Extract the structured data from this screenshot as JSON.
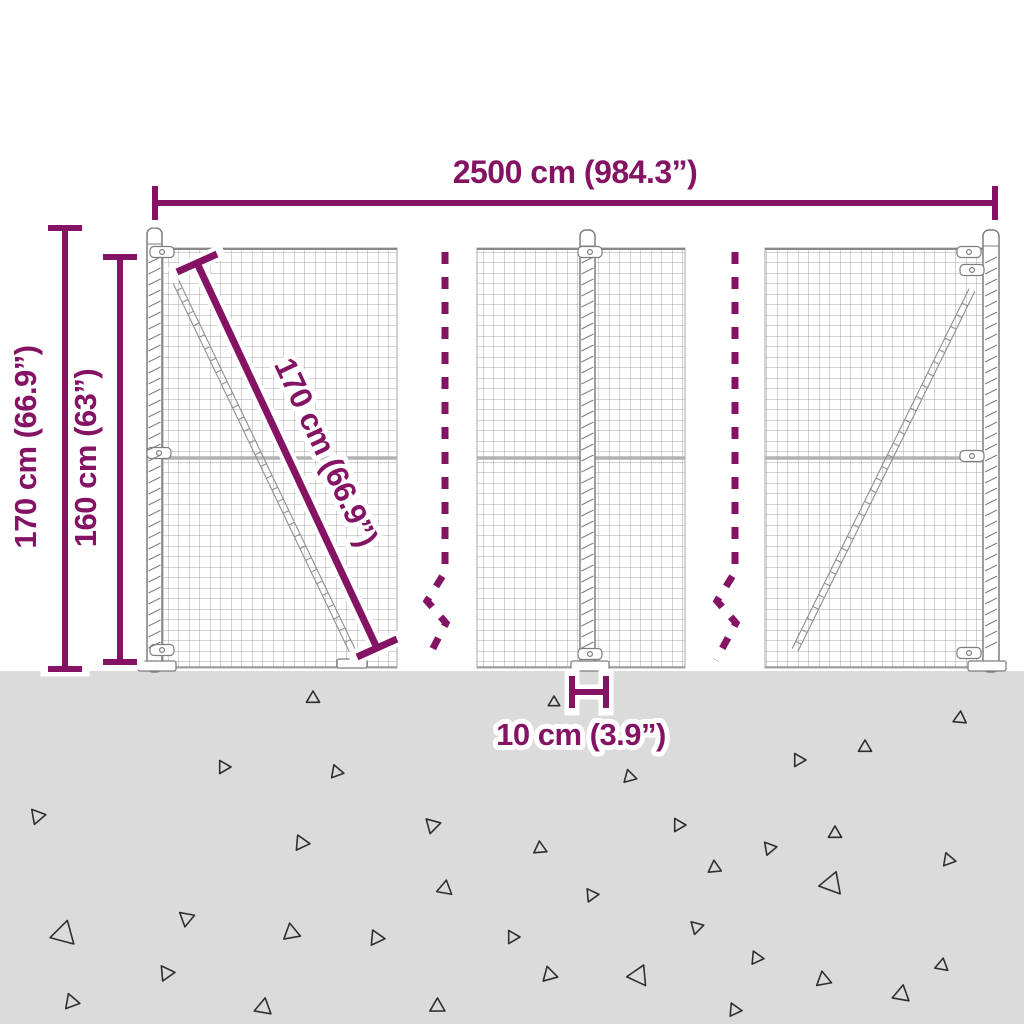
{
  "colors": {
    "accent": "#841363",
    "background": "#ffffff",
    "ground": "#dbdbdb",
    "mesh_line": "#a7a7a7",
    "mesh_wire": "#8a8a8a",
    "rail": "#b3b3b3",
    "post_stroke": "#7e7e7e",
    "hardware": "#8f8f8f",
    "triangle": "#2f2f2f"
  },
  "dimensions": {
    "total_width_label": "2500 cm (984.3”)",
    "post_height_label": "170 cm (66.9”)",
    "mesh_height_label": "160 cm (63”)",
    "panel_diagonal_label": "170 cm (66.9”)",
    "anchor_label": "10 cm (3.9”)"
  },
  "ground": {
    "triangles": [
      [
        313,
        698,
        7,
        0
      ],
      [
        224,
        767,
        7,
        90
      ],
      [
        337,
        772,
        7,
        100
      ],
      [
        38,
        816,
        8,
        80
      ],
      [
        433,
        825,
        8,
        75
      ],
      [
        302,
        843,
        8,
        95
      ],
      [
        445,
        888,
        8,
        10
      ],
      [
        187,
        918,
        8,
        70
      ],
      [
        64,
        933,
        13,
        15
      ],
      [
        292,
        933,
        9,
        110
      ],
      [
        167,
        973,
        8,
        85
      ],
      [
        72,
        1002,
        8,
        100
      ],
      [
        264,
        1008,
        9,
        130
      ],
      [
        377,
        938,
        8,
        95
      ],
      [
        438,
        1007,
        8,
        120
      ],
      [
        554,
        702,
        6,
        0
      ],
      [
        960,
        718,
        7,
        5
      ],
      [
        865,
        747,
        7,
        0
      ],
      [
        799,
        760,
        7,
        90
      ],
      [
        630,
        777,
        7,
        105
      ],
      [
        679,
        825,
        7,
        90
      ],
      [
        770,
        848,
        7,
        80
      ],
      [
        835,
        833,
        7,
        0
      ],
      [
        540,
        848,
        7,
        355
      ],
      [
        949,
        860,
        7,
        100
      ],
      [
        715,
        868,
        7,
        115
      ],
      [
        592,
        895,
        7,
        85
      ],
      [
        832,
        883,
        12,
        20
      ],
      [
        697,
        927,
        7,
        75
      ],
      [
        513,
        937,
        7,
        90
      ],
      [
        757,
        958,
        7,
        95
      ],
      [
        942,
        965,
        7,
        10
      ],
      [
        824,
        980,
        8,
        110
      ],
      [
        550,
        975,
        8,
        105
      ],
      [
        902,
        995,
        9,
        130
      ],
      [
        639,
        975,
        11,
        25
      ],
      [
        735,
        1010,
        7,
        95
      ]
    ]
  }
}
